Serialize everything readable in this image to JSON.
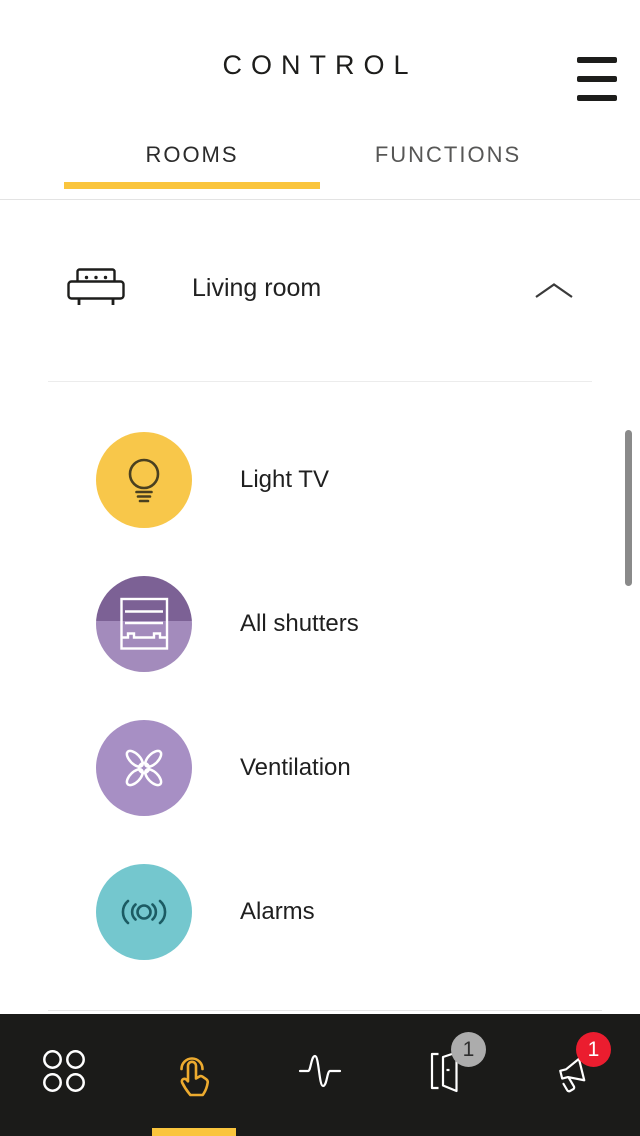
{
  "header": {
    "title": "CONTROL",
    "menu_icon": "hamburger-icon"
  },
  "tabs": {
    "rooms": "ROOMS",
    "functions": "FUNCTIONS",
    "active_tab": "ROOMS"
  },
  "room": {
    "name": "Living room",
    "icon": "couch-icon",
    "collapse_icon": "chevron-up-icon",
    "expanded": true
  },
  "devices": [
    {
      "label": "Light TV",
      "icon": "light-bulb-icon",
      "bg": "#F8C74A",
      "icon_color": "#4A4020"
    },
    {
      "label": "All shutters",
      "icon": "shutter-icon",
      "bg_top": "#7C6195",
      "bg_bottom": "#A38BBC",
      "icon_color": "#FFFFFF"
    },
    {
      "label": "Ventilation",
      "icon": "fan-icon",
      "bg": "#A78FC4",
      "icon_color": "#FFFFFF"
    },
    {
      "label": "Alarms",
      "icon": "alarm-waves-icon",
      "bg": "#74C7CE",
      "icon_color": "#1C5B63"
    }
  ],
  "bottom_nav": {
    "active_index": 1,
    "items": [
      {
        "icon": "grid-circles-icon",
        "active": false
      },
      {
        "icon": "touch-hand-icon",
        "active": true
      },
      {
        "icon": "pulse-wave-icon",
        "active": false
      },
      {
        "icon": "open-door-icon",
        "active": false,
        "badge": "1",
        "badge_color": "#ACACAC"
      },
      {
        "icon": "siren-icon",
        "active": false,
        "badge": "1",
        "badge_color": "#EB1D2F"
      }
    ]
  },
  "colors": {
    "accent_yellow": "#FAC53D",
    "hand_yellow": "#EDAB2F",
    "nav_background": "#1B1B19",
    "badge_gray": "#ACACAC",
    "badge_red": "#EB1D2F",
    "scrollbar": "#8A8A8A"
  }
}
